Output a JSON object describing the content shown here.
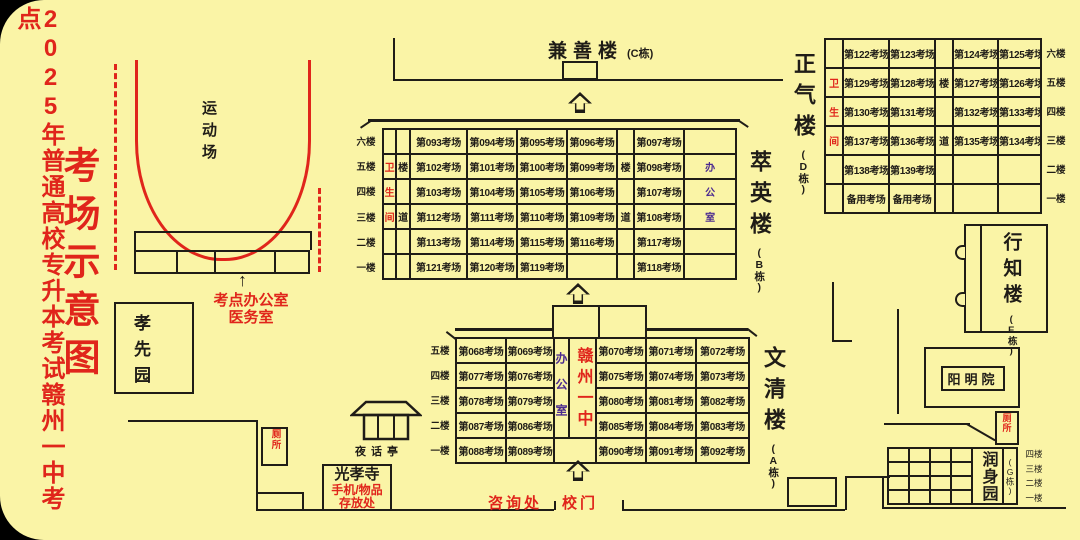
{
  "page": {
    "title_vertical": "2025年普通高校专升本考试赣州一中考点",
    "map_title": "考场示意图"
  },
  "icons": {
    "thin_up_arrow": "↑",
    "up_arrow": "hollow-up-arrow-css-shape"
  },
  "colors": {
    "background": "#FAF4A6",
    "red": "#E0251B",
    "purple": "#4B2A8F",
    "line": "#1f1c17"
  },
  "labels": {
    "playground": "运动场",
    "site_office_line1": "考点办公室",
    "site_office_line2": "医务室",
    "xiaoxian_garden": "孝先园",
    "toilet": "厕所",
    "pavilion": "夜话亭",
    "temple_name": "光孝寺",
    "temple_note1": "手机/物品",
    "temple_note2": "存放处",
    "consult": "咨询处",
    "gate": "校门"
  },
  "buildings": {
    "c": {
      "name": "兼善楼",
      "tag": "(C栋)"
    },
    "b": {
      "name": "萃英楼",
      "tag": "(B栋)",
      "floors": [
        "六楼",
        "五楼",
        "四楼",
        "三楼",
        "二楼",
        "一楼"
      ],
      "table": {
        "col_widths": [
          13,
          14,
          57,
          50,
          50,
          50,
          17,
          50,
          52
        ],
        "row_height": 25,
        "rows": [
          [
            {
              "t": ""
            },
            {
              "t": ""
            },
            {
              "t": "第093考场"
            },
            {
              "t": "第094考场"
            },
            {
              "t": "第095考场"
            },
            {
              "t": "第096考场"
            },
            {
              "t": ""
            },
            {
              "t": "第097考场"
            },
            {
              "t": ""
            }
          ],
          [
            {
              "t": "卫",
              "c": "red"
            },
            {
              "t": "楼"
            },
            {
              "t": "第102考场"
            },
            {
              "t": "第101考场"
            },
            {
              "t": "第100考场"
            },
            {
              "t": "第099考场"
            },
            {
              "t": "楼"
            },
            {
              "t": "第098考场"
            },
            {
              "t": "办",
              "c": "purple"
            }
          ],
          [
            {
              "t": "生",
              "c": "red"
            },
            {
              "t": ""
            },
            {
              "t": "第103考场"
            },
            {
              "t": "第104考场"
            },
            {
              "t": "第105考场"
            },
            {
              "t": "第106考场"
            },
            {
              "t": ""
            },
            {
              "t": "第107考场"
            },
            {
              "t": "公",
              "c": "purple"
            }
          ],
          [
            {
              "t": "间",
              "c": "red"
            },
            {
              "t": "道"
            },
            {
              "t": "第112考场"
            },
            {
              "t": "第111考场"
            },
            {
              "t": "第110考场"
            },
            {
              "t": "第109考场"
            },
            {
              "t": "道"
            },
            {
              "t": "第108考场"
            },
            {
              "t": "室",
              "c": "purple"
            }
          ],
          [
            {
              "t": ""
            },
            {
              "t": ""
            },
            {
              "t": "第113考场"
            },
            {
              "t": "第114考场"
            },
            {
              "t": "第115考场"
            },
            {
              "t": "第116考场"
            },
            {
              "t": ""
            },
            {
              "t": "第117考场"
            },
            {
              "t": ""
            }
          ],
          [
            {
              "t": ""
            },
            {
              "t": ""
            },
            {
              "t": "第121考场"
            },
            {
              "t": "第120考场"
            },
            {
              "t": "第119考场"
            },
            {
              "t": ""
            },
            {
              "t": ""
            },
            {
              "t": "第118考场"
            },
            {
              "t": ""
            }
          ]
        ]
      }
    },
    "a": {
      "name": "文清楼",
      "tag": "(A栋)",
      "floors": [
        "五楼",
        "四楼",
        "三楼",
        "二楼",
        "一楼"
      ],
      "table": {
        "col_widths": [
          50,
          48,
          15,
          27,
          50,
          50,
          53
        ],
        "row_height": 25,
        "rows": [
          [
            {
              "t": "第068考场"
            },
            {
              "t": "第069考场"
            },
            {
              "t": "办公室",
              "c": "office-v",
              "rs": 4
            },
            {
              "t": "赣州一中",
              "c": "center-red",
              "rs": 4
            },
            {
              "t": "第070考场"
            },
            {
              "t": "第071考场"
            },
            {
              "t": "第072考场"
            }
          ],
          [
            {
              "t": "第077考场"
            },
            {
              "t": "第076考场"
            },
            {
              "t": "第075考场"
            },
            {
              "t": "第074考场"
            },
            {
              "t": "第073考场"
            }
          ],
          [
            {
              "t": "第078考场"
            },
            {
              "t": "第079考场"
            },
            {
              "t": "第080考场"
            },
            {
              "t": "第081考场"
            },
            {
              "t": "第082考场"
            }
          ],
          [
            {
              "t": "第087考场"
            },
            {
              "t": "第086考场"
            },
            {
              "t": "第085考场"
            },
            {
              "t": "第084考场"
            },
            {
              "t": "第083考场"
            }
          ],
          [
            {
              "t": "第088考场"
            },
            {
              "t": "第089考场"
            },
            {
              "t": "",
              "cs": 2
            },
            {
              "t": "第090考场"
            },
            {
              "t": "第091考场"
            },
            {
              "t": "第092考场"
            }
          ]
        ]
      }
    },
    "d": {
      "name": "正气楼",
      "tag": "(D栋)",
      "floors": [
        "六楼",
        "五楼",
        "四楼",
        "三楼",
        "二楼",
        "一楼"
      ],
      "table": {
        "col_widths": [
          18,
          46,
          46,
          18,
          45,
          43
        ],
        "row_height": 29,
        "rows": [
          [
            {
              "t": ""
            },
            {
              "t": "第122考场"
            },
            {
              "t": "第123考场"
            },
            {
              "t": ""
            },
            {
              "t": "第124考场"
            },
            {
              "t": "第125考场"
            }
          ],
          [
            {
              "t": "卫",
              "c": "red"
            },
            {
              "t": "第129考场"
            },
            {
              "t": "第128考场"
            },
            {
              "t": "楼"
            },
            {
              "t": "第127考场"
            },
            {
              "t": "第126考场"
            }
          ],
          [
            {
              "t": "生",
              "c": "red"
            },
            {
              "t": "第130考场"
            },
            {
              "t": "第131考场"
            },
            {
              "t": ""
            },
            {
              "t": "第132考场"
            },
            {
              "t": "第133考场"
            }
          ],
          [
            {
              "t": "间",
              "c": "red"
            },
            {
              "t": "第137考场"
            },
            {
              "t": "第136考场"
            },
            {
              "t": "道"
            },
            {
              "t": "第135考场"
            },
            {
              "t": "第134考场"
            }
          ],
          [
            {
              "t": ""
            },
            {
              "t": "第138考场"
            },
            {
              "t": "第139考场"
            },
            {
              "t": ""
            },
            {
              "t": ""
            },
            {
              "t": ""
            }
          ],
          [
            {
              "t": ""
            },
            {
              "t": "备用考场"
            },
            {
              "t": "备用考场"
            },
            {
              "t": ""
            },
            {
              "t": ""
            },
            {
              "t": ""
            }
          ]
        ]
      }
    },
    "e": {
      "name": "行知楼",
      "tag": "(E栋)"
    },
    "yangming": {
      "name": "阳明院"
    },
    "g": {
      "name": "润身园",
      "tag": "(G栋)",
      "floors": [
        "四楼",
        "三楼",
        "二楼",
        "一楼"
      ],
      "table": {
        "col_widths": [
          21,
          21,
          21,
          21,
          31,
          14
        ],
        "row_height": 14,
        "rows": [
          [
            {
              "t": ""
            },
            {
              "t": ""
            },
            {
              "t": ""
            },
            {
              "t": ""
            },
            {
              "t": "润身园",
              "c": "g-name",
              "rs": 4
            },
            {
              "t": "(G栋)",
              "c": "g-tag",
              "rs": 4
            }
          ],
          [
            {
              "t": ""
            },
            {
              "t": ""
            },
            {
              "t": ""
            },
            {
              "t": ""
            }
          ],
          [
            {
              "t": ""
            },
            {
              "t": ""
            },
            {
              "t": ""
            },
            {
              "t": ""
            }
          ],
          [
            {
              "t": ""
            },
            {
              "t": ""
            },
            {
              "t": ""
            },
            {
              "t": ""
            }
          ]
        ]
      }
    }
  }
}
